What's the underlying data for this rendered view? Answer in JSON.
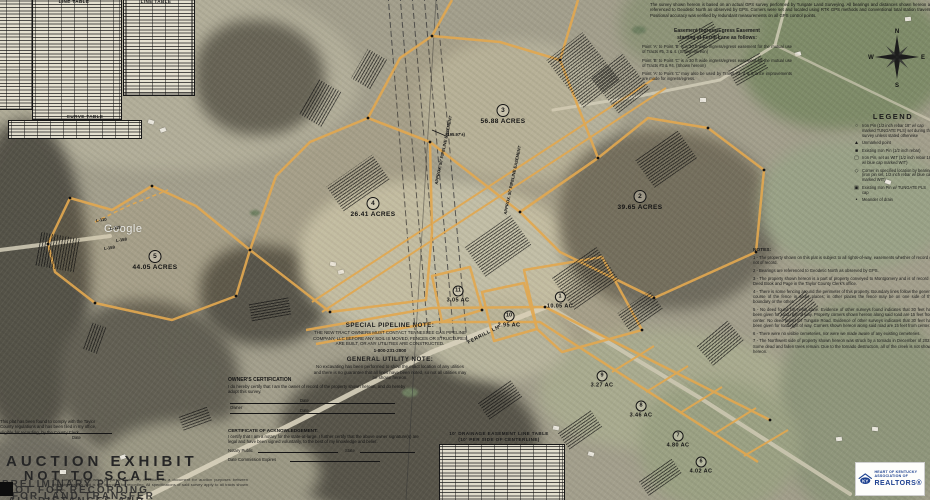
{
  "title_block": {
    "survey_note": "The survey shown hereon is based on an actual GPS survey performed by Tungate Land Surveying. All bearings and distances shown hereon are referenced to Geodetic North as observed by GPS. Corners were set and located using RTK GPS methods and conventional total station traverse. Positional accuracy was verified by redundant measurements on all GPS control points."
  },
  "easement_note": {
    "title_line1": "Easement  Ingress/Egress Easement",
    "title_line2": "starting at Ferrill Lane as follows:",
    "paragraphs": [
      "Point 'A' to Point 'B' is a 30 ft wide ingress/egress easement for the mutual use of Tracts #5, 3 & 4. (Shown hereon)",
      "Point 'B' to Point 'C' is a 30 ft wide ingress/egress easement for the mutual use of Tracts #3 & #4. (Shown hereon)",
      "Point 'A' to Point 'C' may also be used by Tracts #3, 4 & 5 once improvements are made for ingress/egress."
    ]
  },
  "tables": {
    "line_table_title": "LINE TABLE",
    "curve_table_title": "CURVE TABLE",
    "drainage_table_title_1": "10' DRAINAGE EASEMENT LINE TABLE",
    "drainage_table_title_2": "(10' PER SIDE OF CENTERLINE)"
  },
  "legend": {
    "title": "LEGEND",
    "items": [
      {
        "symbol": "○",
        "text": "Iron Pin (1/2 inch rebar 18\" w/ cap marked TUNGATE PLS) set during this survey unless stated otherwise"
      },
      {
        "symbol": "▲",
        "text": "Unmarked point"
      },
      {
        "symbol": "■",
        "text": "Existing Iron Pin (1/2 inch rebar)"
      },
      {
        "symbol": "▢",
        "text": "Iron Pin, set as WIT (1/2 inch rebar 18\" w/ blue cap marked WIT)"
      },
      {
        "symbol": "◇",
        "text": "Corner in specified location by bearing (iron pin set, 1/2 inch rebar w/ blue cap marked WIT)"
      },
      {
        "symbol": "▣",
        "text": "Existing Iron Pin w/ TUNGATE PLS cap"
      },
      {
        "symbol": "•",
        "text": "Meander of drain"
      }
    ]
  },
  "notes": {
    "title": "NOTES:",
    "items": [
      "1 - The property shown on this plat is subject to all rights-of-way, easements whether of record or not of record.",
      "2 - Bearings are referenced to Geodetic North as observed by GPS.",
      "3 - The property shown hereon is a part of property conveyed to Montgomery and is of record in Deed Book and Page in the Taylor County Clerk's office.",
      "4 - There is some fencing around the perimeter of this property. Boundary lines follow the general course of the fence in some places; in other places the fence may be on one side of the boundary or the other.",
      "5 - No deed found for Ferrill Lane. Evidence of other surveys found indicates that 30 feet has been given for road right of way. Property corners shown hereon along said road are 15 feet from center. No deed found for Tungate Road. Evidence of other surveys indicates that 30 feet has been given for road right of way. Corners shown hereon along said road are 15 feet from center.",
      "6 - There were no visible cemeteries, nor were we made aware of any existing cemeteries.",
      "7 - The Northwest side of property shown hereon was struck by a tornado in December of 2021. Some dead and fallen trees remain. Due to the tornado destruction, all of the creek is not shown hereon."
    ]
  },
  "pipeline_note": {
    "title": "SPECIAL PIPELINE NOTE:",
    "body": "THE NEW TRACT OWNERS MUST CONTACT TENNESSEE GAS PIPELINE COMPANY, LLC BEFORE ANY SOIL IS MOVED, FENCES OR STRUCTURES ARE BUILT, OR ANY UTILITIES ARE CONSTRUCTED.",
    "phone": "1-800-231-2800"
  },
  "utility_note": {
    "title": "GENERAL UTILITY NOTE:",
    "body": "No excavating has been performed to show the exact location of any utilities and there is no guarantee that all lines have been noted, so not all utilities may be shown hereon."
  },
  "owner_certification": {
    "title": "OWNER'S CERTIFICATION",
    "body": "I do hereby certify that I am the owner of record of the property shown hereon, and do hereby adopt this survey.",
    "owner_label": "Owner",
    "date_label": "Date"
  },
  "acknowledgement": {
    "title": "CERTIFICATE OF ACKNOWLEDGEMENT:",
    "body": "I certify that I am a notary for the state-at-large. I further certify that the above owner signature(s) are legal and have been signed voluntarily, to the best of my knowledge and belief.",
    "notary_label": "Notary Public",
    "state_label": "State",
    "commission_label": "Date Commission Expires"
  },
  "clerk_block": {
    "body": "This plat has been found to comply with the Taylor County regulations and has been filed in my office, eligible for recording, by the County Clerk.",
    "date_label": "Date"
  },
  "stamps": {
    "line1": "AUCTION  EXHIBIT",
    "line2": "NOT  TO  SCALE",
    "overlay": [
      "PRELIMINARY PLAT",
      "NOT FOR RECORDING",
      "FOR LAND TRANSFER",
      "ALL DISTANCES AND"
    ],
    "fine_print": "This survey and plat were prepared, under my direction, as a document for auction purposes between interested parties and is not intended for recording. All specifications of said survey apply to all tracts shown hereon."
  },
  "tracts": [
    {
      "num": "1",
      "acres": "10.05 AC"
    },
    {
      "num": "2",
      "acres": "39.65 ACRES"
    },
    {
      "num": "3",
      "acres": "56.88 ACRES"
    },
    {
      "num": "4",
      "acres": "26.41 ACRES"
    },
    {
      "num": "5",
      "acres": "44.05 ACRES"
    },
    {
      "num": "6",
      "acres": "4.02 AC"
    },
    {
      "num": "7",
      "acres": "4.80 AC"
    },
    {
      "num": "8",
      "acres": "3.46 AC"
    },
    {
      "num": "9",
      "acres": "3.27 AC"
    },
    {
      "num": "10",
      "acres": "2.95 AC"
    },
    {
      "num": "11",
      "acres": "3.05 AC"
    }
  ],
  "map_labels": [
    {
      "id": "google",
      "text": "Google"
    },
    {
      "id": "ferrill-ln",
      "text": "FERRILL LN"
    },
    {
      "id": "dim-195",
      "text": "(195.97'±)"
    },
    {
      "id": "easement-1",
      "text": "APPROX. 50' PIPELINE EASEMENT"
    },
    {
      "id": "easement-2",
      "text": "APPROX. 50' PIPELINE EASEMENT"
    },
    {
      "id": "l-110",
      "text": "L-110"
    },
    {
      "id": "l-119",
      "text": "L-119"
    },
    {
      "id": "l-158",
      "text": "L-158"
    },
    {
      "id": "l-159",
      "text": "L-159"
    }
  ],
  "compass": {
    "n": "N",
    "e": "E",
    "s": "S",
    "w": "W"
  },
  "logo": {
    "abbr": "KY",
    "line1": "HEART OF KENTUCKY",
    "line2": "ASSOCIATION OF",
    "realtors": "REALTORS®"
  }
}
